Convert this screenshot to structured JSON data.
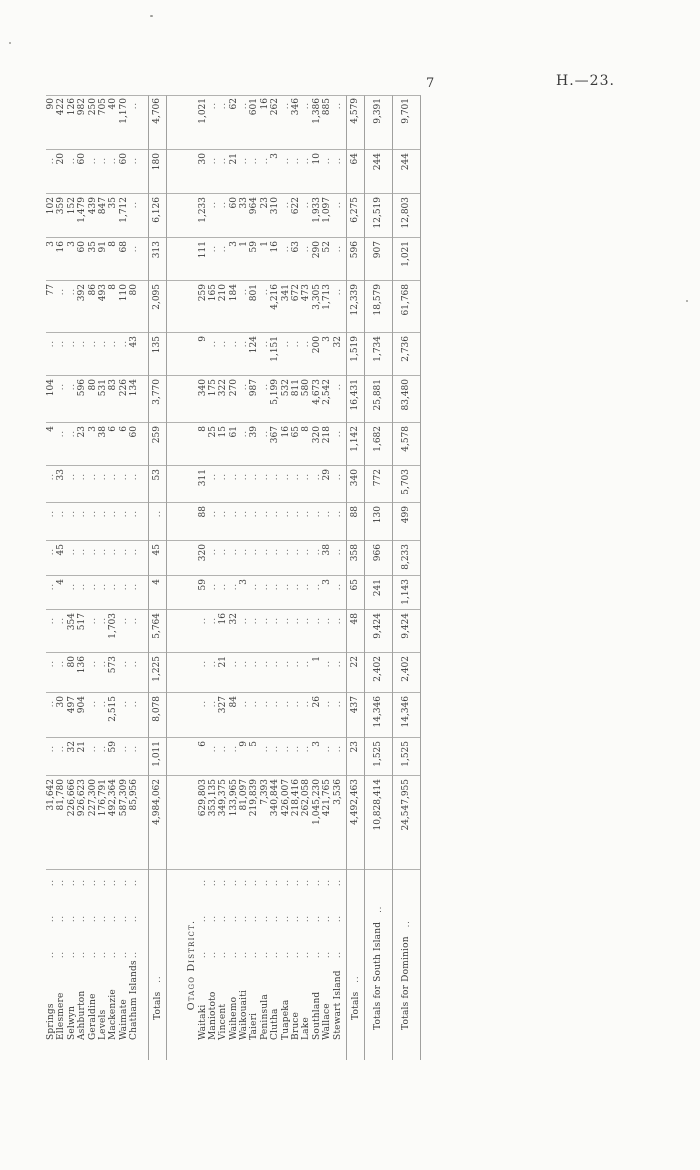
{
  "page": {
    "number": "7",
    "doc_ref": "H.—23."
  },
  "table": {
    "canterbury_rows": [
      {
        "name": "Springs",
        "values": [
          "31,642",
          "..",
          "..",
          "..",
          "..",
          "..",
          "..",
          "..",
          "..",
          "4",
          "104",
          "..",
          "77",
          "3",
          "102",
          "..",
          "90"
        ]
      },
      {
        "name": "Ellesmere",
        "values": [
          "81,780",
          "..",
          "30",
          "..",
          "..",
          "4",
          "45",
          "..",
          "33",
          "..",
          "..",
          "..",
          "..",
          "16",
          "359",
          "20",
          "422"
        ]
      },
      {
        "name": "Selwyn",
        "values": [
          "226,666",
          "32",
          "497",
          "80",
          "354",
          "..",
          "..",
          "..",
          "..",
          "..",
          "..",
          "..",
          "..",
          "3",
          "152",
          "..",
          "126"
        ]
      },
      {
        "name": "Ashburton",
        "values": [
          "926,623",
          "21",
          "904",
          "136",
          "517",
          "..",
          "..",
          "..",
          "..",
          "23",
          "596",
          "..",
          "392",
          "60",
          "1,479",
          "60",
          "982"
        ]
      },
      {
        "name": "Geraldine",
        "values": [
          "227,300",
          "..",
          "..",
          "..",
          "..",
          "..",
          "..",
          "..",
          "..",
          "3",
          "80",
          "..",
          "86",
          "35",
          "439",
          "..",
          "250"
        ]
      },
      {
        "name": "Levels",
        "values": [
          "176,791",
          "..",
          "..",
          "..",
          "..",
          "..",
          "..",
          "..",
          "..",
          "38",
          "531",
          "..",
          "493",
          "91",
          "847",
          "..",
          "705"
        ]
      },
      {
        "name": "Mackenzie",
        "values": [
          "492,364",
          "59",
          "2,515",
          "573",
          "1,703",
          "..",
          "..",
          "..",
          "..",
          "6",
          "83",
          "..",
          "8",
          "8",
          "35",
          "..",
          "40"
        ]
      },
      {
        "name": "Waimate",
        "values": [
          "587,309",
          "..",
          "..",
          "..",
          "..",
          "..",
          "..",
          "..",
          "..",
          "6",
          "226",
          "..",
          "110",
          "68",
          "1,712",
          "60",
          "1,170"
        ]
      },
      {
        "name": "Chatham Islands",
        "values": [
          "85,956",
          "..",
          "..",
          "..",
          "..",
          "..",
          "..",
          "..",
          "..",
          "60",
          "134",
          "43",
          "80",
          "..",
          "..",
          "..",
          ".."
        ]
      }
    ],
    "canterbury_totals": {
      "label": "Totals",
      "values": [
        "4,984,062",
        "1,011",
        "8,078",
        "1,225",
        "5,764",
        "4",
        "45",
        "..",
        "53",
        "259",
        "3,770",
        "135",
        "2,095",
        "313",
        "6,126",
        "180",
        "4,706"
      ]
    },
    "otago_header": "Otago District.",
    "otago_rows": [
      {
        "name": "Waitaki",
        "values": [
          "629,803",
          "6",
          "..",
          "..",
          "..",
          "59",
          "320",
          "88",
          "311",
          "8",
          "340",
          "9",
          "259",
          "111",
          "1,233",
          "30",
          "1,021"
        ]
      },
      {
        "name": "Maniototo",
        "values": [
          "353,135",
          "..",
          "..",
          "..",
          "..",
          "..",
          "..",
          "..",
          "..",
          "25",
          "175",
          "..",
          "165",
          "..",
          "..",
          "..",
          ".."
        ]
      },
      {
        "name": "Vincent",
        "values": [
          "349,375",
          "..",
          "327",
          "21",
          "16",
          "..",
          "..",
          "..",
          "..",
          "15",
          "322",
          "..",
          "210",
          "..",
          "..",
          "..",
          ".."
        ]
      },
      {
        "name": "Waihemo",
        "values": [
          "133,965",
          "..",
          "84",
          "..",
          "32",
          "..",
          "..",
          "..",
          "..",
          "61",
          "270",
          "..",
          "184",
          "3",
          "60",
          "21",
          "62"
        ]
      },
      {
        "name": "Waikouaiti",
        "values": [
          "81,097",
          "9",
          "..",
          "..",
          "..",
          "3",
          "..",
          "..",
          "..",
          "..",
          "..",
          "..",
          "..",
          "1",
          "33",
          "..",
          ".."
        ]
      },
      {
        "name": "Taieri",
        "values": [
          "219,839",
          "5",
          "..",
          "..",
          "..",
          "..",
          "..",
          "..",
          "..",
          "39",
          "987",
          "124",
          "801",
          "59",
          "964",
          "..",
          "601"
        ]
      },
      {
        "name": "Peninsula",
        "values": [
          "7,393",
          "..",
          "..",
          "..",
          "..",
          "..",
          "..",
          "..",
          "..",
          "..",
          "..",
          "..",
          "..",
          "1",
          "23",
          "..",
          "16"
        ]
      },
      {
        "name": "Clutha",
        "values": [
          "340,844",
          "..",
          "..",
          "..",
          "..",
          "..",
          "..",
          "..",
          "..",
          "367",
          "5,199",
          "1,151",
          "4,216",
          "16",
          "310",
          "3",
          "262"
        ]
      },
      {
        "name": "Tuapeka",
        "values": [
          "426,007",
          "..",
          "..",
          "..",
          "..",
          "..",
          "..",
          "..",
          "..",
          "16",
          "532",
          "..",
          "341",
          "..",
          "..",
          "..",
          ".."
        ]
      },
      {
        "name": "Bruce",
        "values": [
          "218,416",
          "..",
          "..",
          "..",
          "..",
          "..",
          "..",
          "..",
          "..",
          "65",
          "811",
          "..",
          "672",
          "63",
          "622",
          "..",
          "346"
        ]
      },
      {
        "name": "Lake",
        "values": [
          "262,058",
          "..",
          "..",
          "..",
          "..",
          "..",
          "..",
          "..",
          "..",
          "8",
          "580",
          "..",
          "473",
          "..",
          "..",
          "..",
          ".."
        ]
      },
      {
        "name": "Southland",
        "values": [
          "1,045,230",
          "3",
          "26",
          "1",
          "..",
          "..",
          "..",
          "..",
          "..",
          "320",
          "4,673",
          "200",
          "3,305",
          "290",
          "1,933",
          "10",
          "1,386"
        ]
      },
      {
        "name": "Wallace",
        "values": [
          "421,765",
          "..",
          "..",
          "..",
          "..",
          "3",
          "38",
          "..",
          "29",
          "218",
          "2,542",
          "3",
          "1,713",
          "52",
          "1,097",
          "..",
          "885"
        ]
      },
      {
        "name": "Stewart Island",
        "values": [
          "3,536",
          "..",
          "..",
          "..",
          "..",
          "..",
          "..",
          "..",
          "..",
          "..",
          "..",
          "32",
          "..",
          "..",
          "..",
          "..",
          ".."
        ]
      }
    ],
    "otago_totals": {
      "label": "Totals",
      "values": [
        "4,492,463",
        "23",
        "437",
        "22",
        "48",
        "65",
        "358",
        "88",
        "340",
        "1,142",
        "16,431",
        "1,519",
        "12,339",
        "596",
        "6,275",
        "64",
        "4,579"
      ]
    },
    "south_island_totals": {
      "label": "Totals for South Island",
      "values": [
        "10,828,414",
        "1,525",
        "14,346",
        "2,402",
        "9,424",
        "241",
        "966",
        "130",
        "772",
        "1,682",
        "25,881",
        "1,734",
        "18,579",
        "907",
        "12,519",
        "244",
        "9,391"
      ]
    },
    "dominion_totals": {
      "label": "Totals for Dominion",
      "values": [
        "24,547,955",
        "1,525",
        "14,346",
        "2,402",
        "9,424",
        "1,143",
        "8,233",
        "499",
        "5,703",
        "4,578",
        "83,480",
        "2,736",
        "61,768",
        "1,021",
        "12,803",
        "244",
        "9,701"
      ]
    }
  }
}
